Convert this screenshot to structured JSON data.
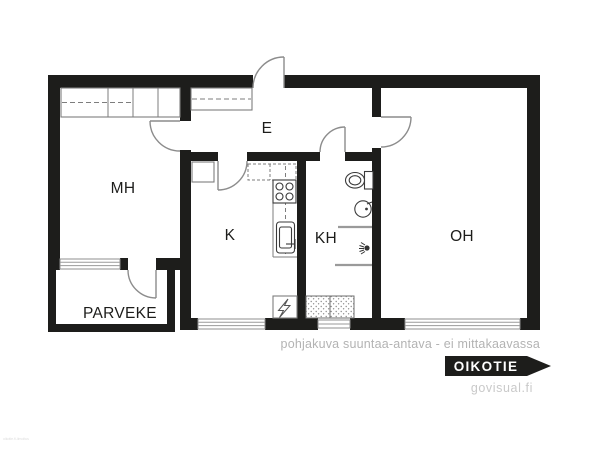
{
  "floorplan": {
    "room_labels": {
      "mh": "MH",
      "e": "E",
      "k": "K",
      "kh": "KH",
      "oh": "OH",
      "parveke": "PARVEKE"
    },
    "fixture_icons": [
      "wardrobe-icon",
      "door-swing-icon",
      "stove-icon",
      "kitchen-sink-icon",
      "electrical-panel-icon",
      "appliance-reservation-icon",
      "toilet-icon",
      "washbasin-icon",
      "shower-icon",
      "window-icon"
    ],
    "colors": {
      "wall": "#1d1d1b",
      "door_line": "#8c8c8c",
      "fixture_line": "#3a3a3a",
      "background": "#ffffff"
    }
  },
  "footer": {
    "disclaimer": "pohjakuva suuntaa-antava - ei mittakaavassa",
    "brand": {
      "logo_text": "OIKOTIE",
      "logo_bg": "#1d1d1b",
      "logo_text_color": "#ffffff"
    },
    "watermark": "govisual.fi",
    "corner_watermark": "oikotie.fi-ilmoitus"
  }
}
